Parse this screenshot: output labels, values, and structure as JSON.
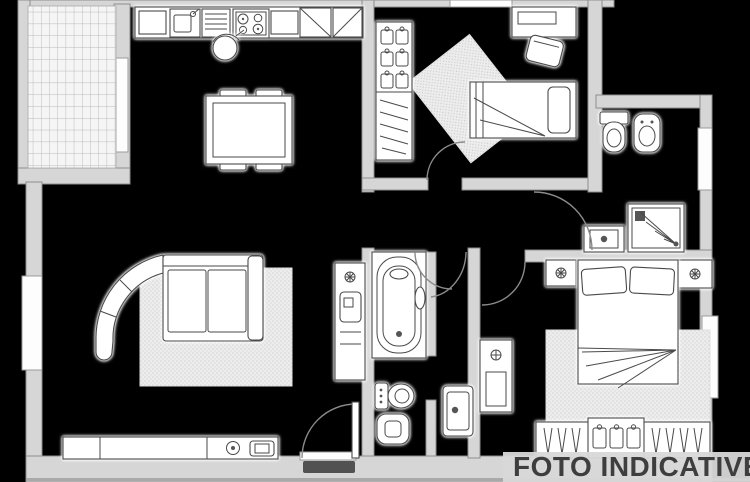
{
  "watermark": {
    "text": "FOTO INDICATIVE"
  },
  "palette": {
    "background": "#000000",
    "wall-fill": "#d6d6d6",
    "wall-stroke": "#8d8d8d",
    "line": "#4a4a4a",
    "furniture-fill": "#ffffff",
    "rug-fill": "#ededed",
    "tile-fill": "#f5f5f5",
    "band-fill": "#d8d8d8",
    "watermark-color": "#3e3e3e"
  },
  "plan": {
    "type": "apartment-floor-plan",
    "rooms": [
      {
        "name": "balcony",
        "features": [
          "tiled-floor",
          "window-to-kitchen"
        ]
      },
      {
        "name": "kitchen-dining",
        "features": [
          "counter",
          "sink",
          "dish-rack",
          "stove",
          "tall-cabinets",
          "stool",
          "dining-table",
          "four-chairs"
        ]
      },
      {
        "name": "living-room",
        "features": [
          "corner-sofa",
          "rug",
          "tv-sideboard",
          "entrance-door",
          "side-window"
        ]
      },
      {
        "name": "bedroom-small",
        "features": [
          "wardrobe",
          "angled-rug",
          "desk",
          "desk-chair",
          "single-bed"
        ]
      },
      {
        "name": "bathroom-main",
        "features": [
          "toilet",
          "bidet",
          "shower",
          "washbasin",
          "window"
        ]
      },
      {
        "name": "bathroom-second",
        "features": [
          "bathtub",
          "bidet",
          "toilet",
          "tall-cabinet"
        ]
      },
      {
        "name": "hallway",
        "features": [
          "washbasin",
          "radiator-cabinet",
          "door-arcs"
        ]
      },
      {
        "name": "master-bedroom",
        "features": [
          "double-bed",
          "nightstand-left",
          "nightstand-right",
          "rug",
          "wardrobe",
          "window"
        ]
      }
    ]
  }
}
